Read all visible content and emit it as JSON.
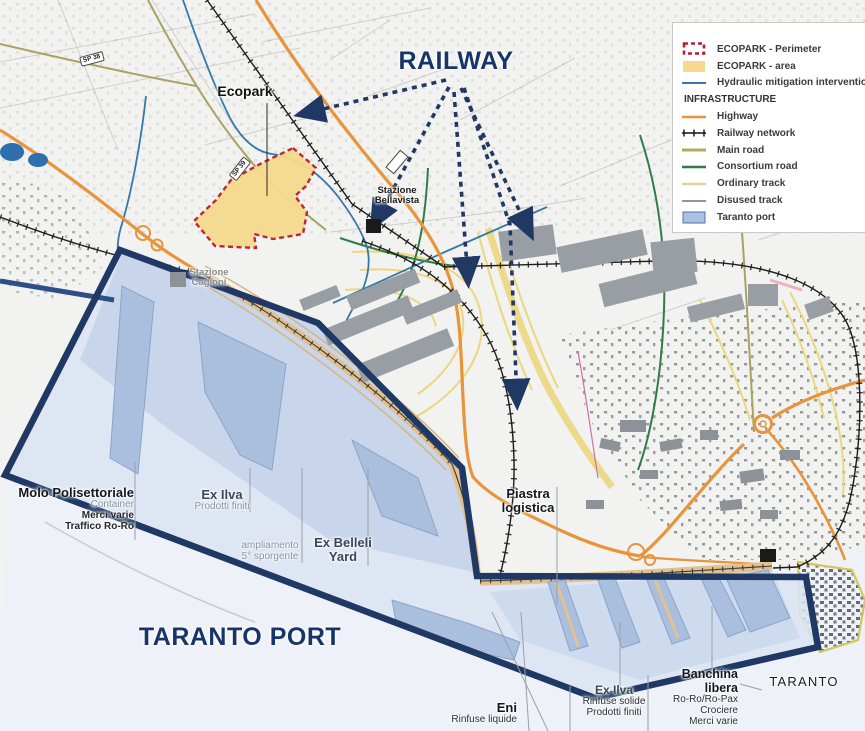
{
  "legend": {
    "items": [
      {
        "label": "ECOPARK - Perimeter"
      },
      {
        "label": "ECOPARK - area"
      },
      {
        "label": "Hydraulic mitigation interventions"
      },
      {
        "label": "INFRASTRUCTURE"
      },
      {
        "label": "Highway"
      },
      {
        "label": "Railway network"
      },
      {
        "label": "Main road"
      },
      {
        "label": "Consortium road"
      },
      {
        "label": "Ordinary track"
      },
      {
        "label": "Disused track"
      },
      {
        "label": "Taranto port"
      }
    ]
  },
  "callouts": {
    "railway": "RAILWAY",
    "taranto_port": "TARANTO PORT"
  },
  "labels": {
    "ecopark": "Ecopark",
    "taranto_city": "TARANTO",
    "sp39": "SP 39",
    "sp38": "SP 38",
    "bellavista_line1": "Stazione",
    "bellavista_line2": "Bellavista",
    "cagioni_line1": "Stazione",
    "cagioni_line2": "Cagioni"
  },
  "zones": {
    "molo": {
      "title": "Molo Polisettoriale",
      "sub": "Container",
      "line1": "Merci varie",
      "line2": "Traffico Ro-Ro"
    },
    "ex_ilva_west": {
      "title": "Ex Ilva",
      "sub": "Prodotti finiti"
    },
    "ampliamento": {
      "line1": "ampliamento",
      "line2": "5° sporgente"
    },
    "ex_belleli": {
      "line1": "Ex Belleli",
      "line2": "Yard"
    },
    "piastra": {
      "line1": "Piastra",
      "line2": "logistica"
    },
    "eni": {
      "title": "Eni",
      "sub": "Rinfuse liquide"
    },
    "ex_ilva_east": {
      "title": "Ex Ilva",
      "sub1": "Rinfuse solide",
      "sub2": "Prodotti finiti"
    },
    "banchina": {
      "title1": "Banchina",
      "title2": "libera",
      "sub1": "Ro-Ro/Ro-Pax",
      "sub2": "Crociere",
      "sub3": "Merci varie"
    }
  },
  "colors": {
    "port_boundary": "#1f3864",
    "ecopark_fill": "#f6d98d",
    "ecopark_border": "#b61f2e",
    "highway": "#e8943a",
    "hydraulic": "#3679a8",
    "main_road": "#a9a262",
    "consortium_road": "#2e7d46",
    "ordinary_track": "#e6d79d",
    "disused_track": "#9b919b",
    "port_fill": "#b7c9e3",
    "callout_text": "#17356b"
  }
}
